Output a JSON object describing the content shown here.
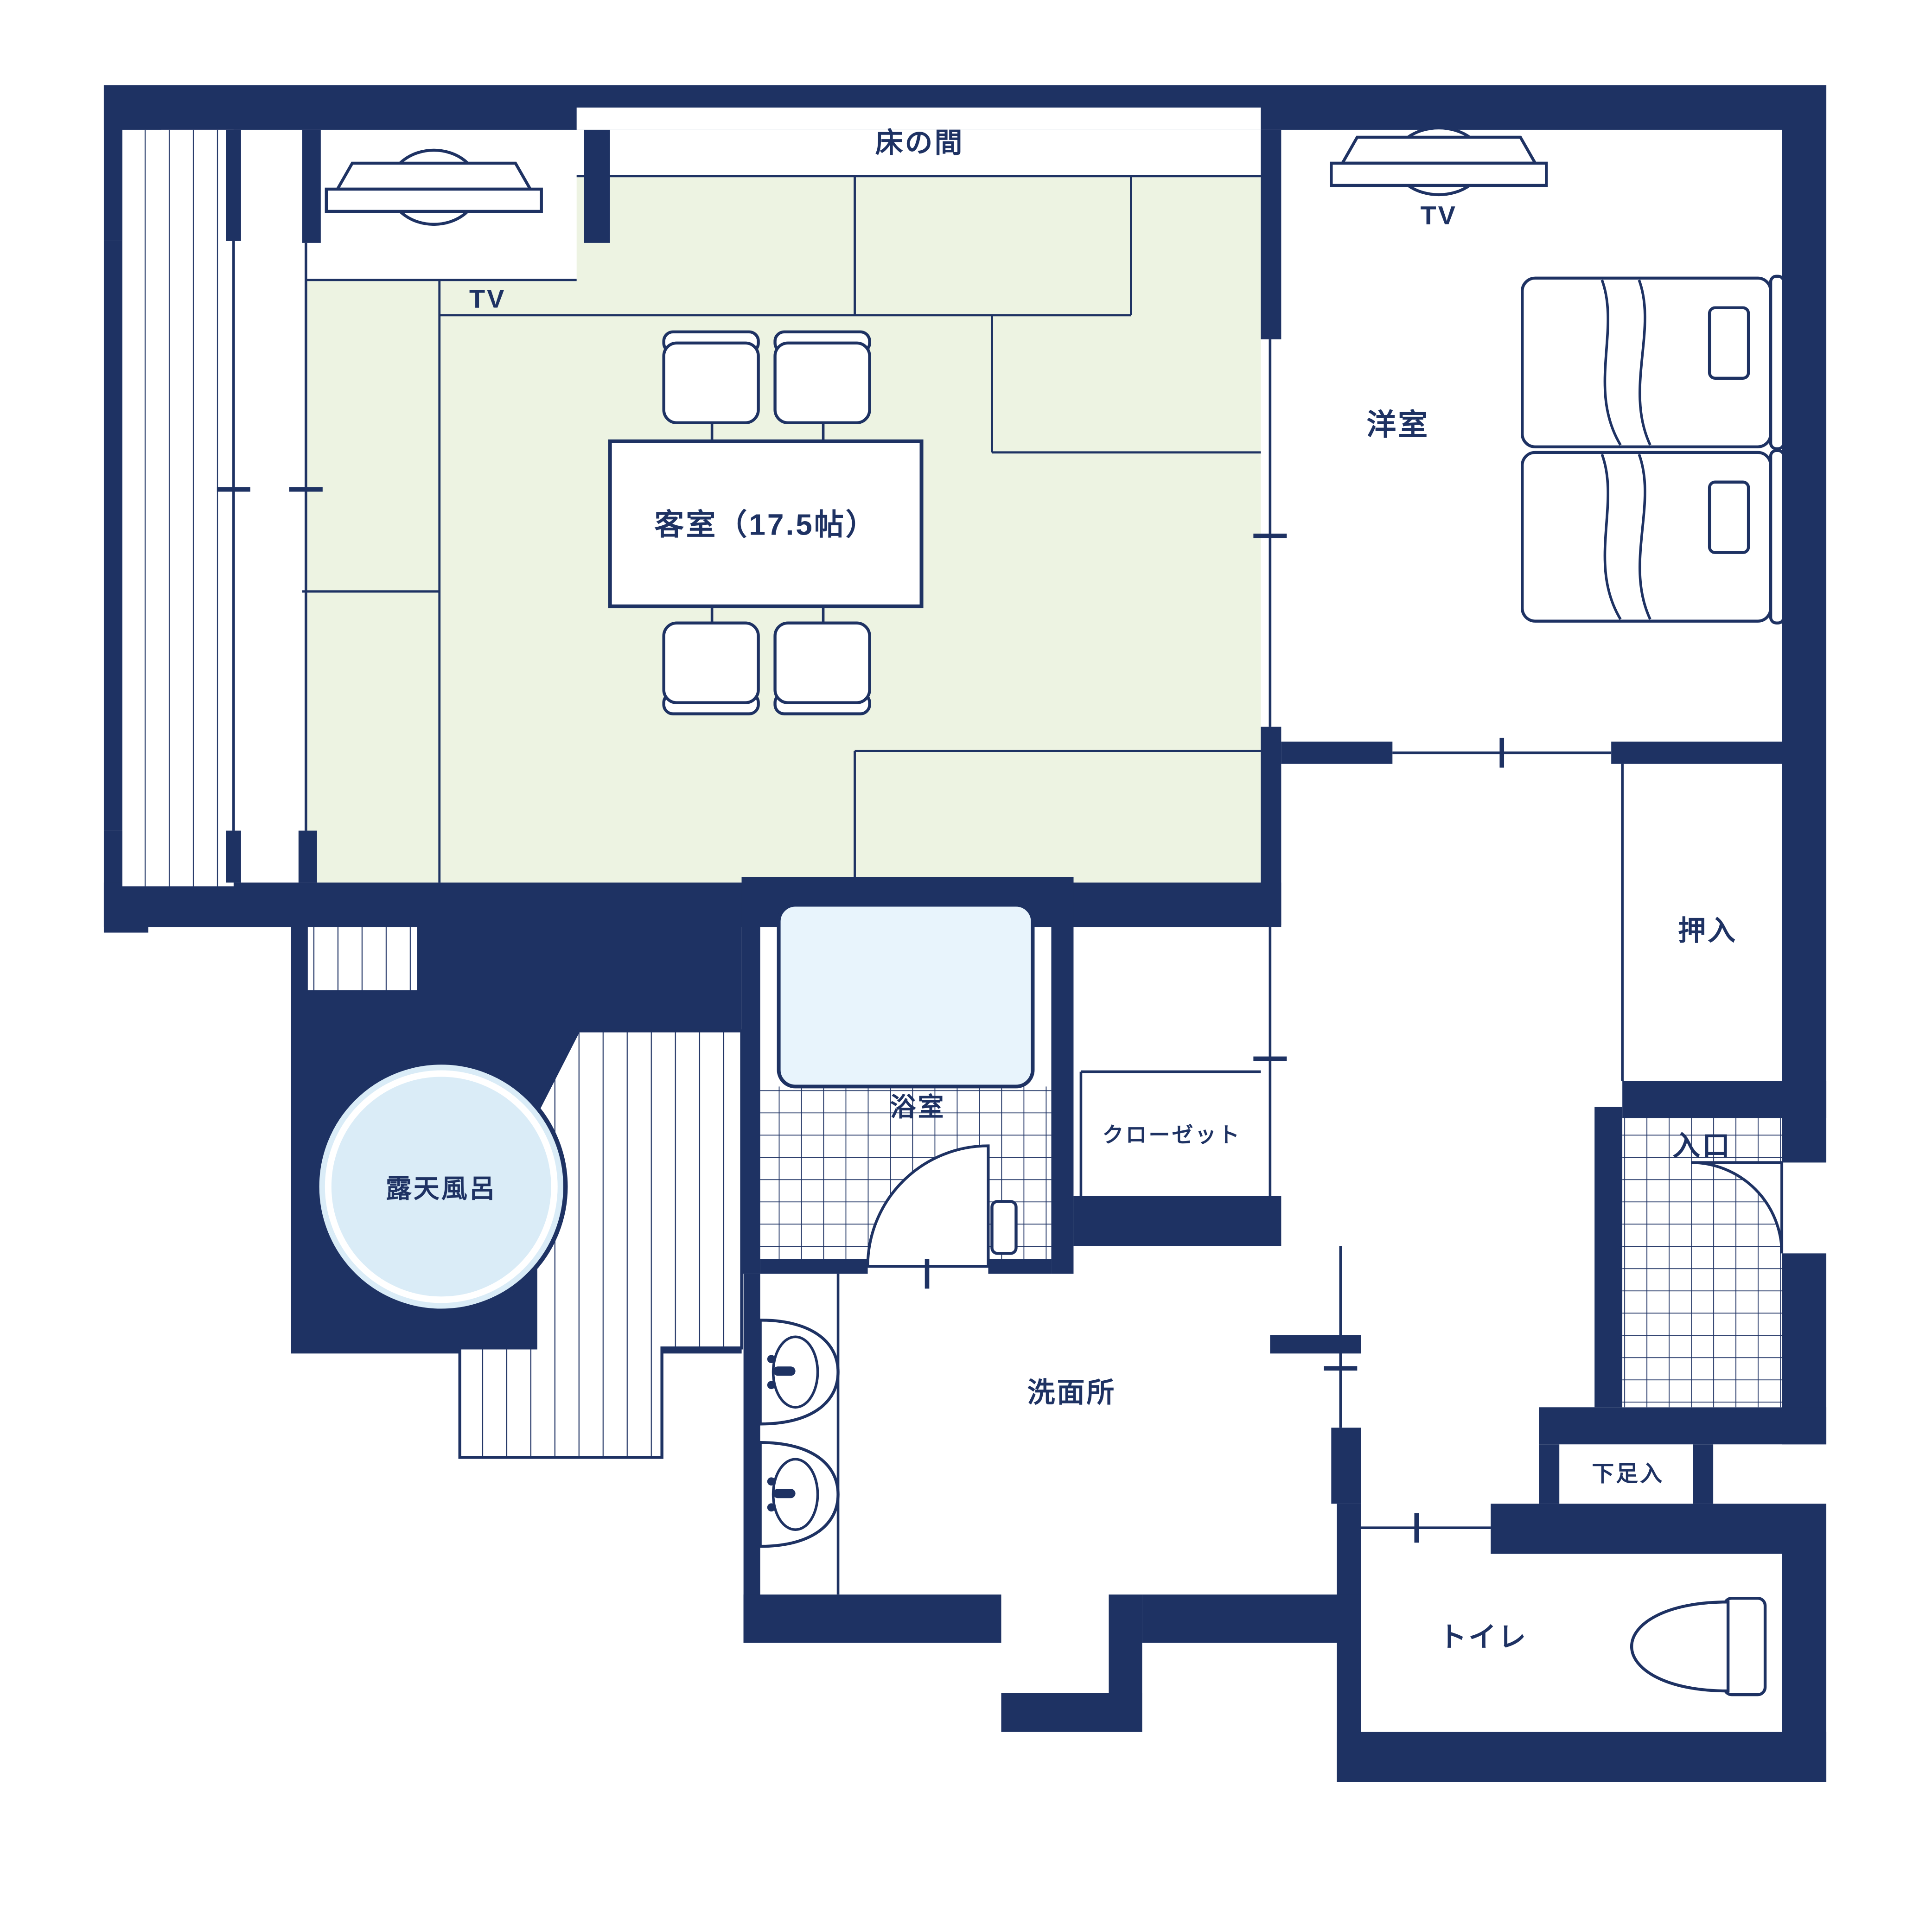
{
  "colors": {
    "wall_navy": "#1e3263",
    "tatami_green": "#edf3e2",
    "bathtub_water": "#e8f4fc",
    "open_air_bath_water": "#daecf7",
    "floor_white": "#ffffff"
  },
  "rooms": {
    "tokonoma": {
      "label": "床の間"
    },
    "guest_room": {
      "label": "客室（17.5帖）"
    },
    "western_room": {
      "label": "洋室"
    },
    "oshiire": {
      "label": "押入"
    },
    "entrance": {
      "label": "入口"
    },
    "closet": {
      "label": "クローゼット"
    },
    "bathroom": {
      "label": "浴室"
    },
    "open_air_bath": {
      "label": "露天風呂"
    },
    "washroom": {
      "label": "洗面所"
    },
    "shoe_cabinet": {
      "label": "下足入"
    },
    "toilet": {
      "label": "トイレ"
    }
  },
  "furniture": {
    "tv_guest": {
      "label": "TV"
    },
    "tv_western": {
      "label": "TV"
    }
  }
}
